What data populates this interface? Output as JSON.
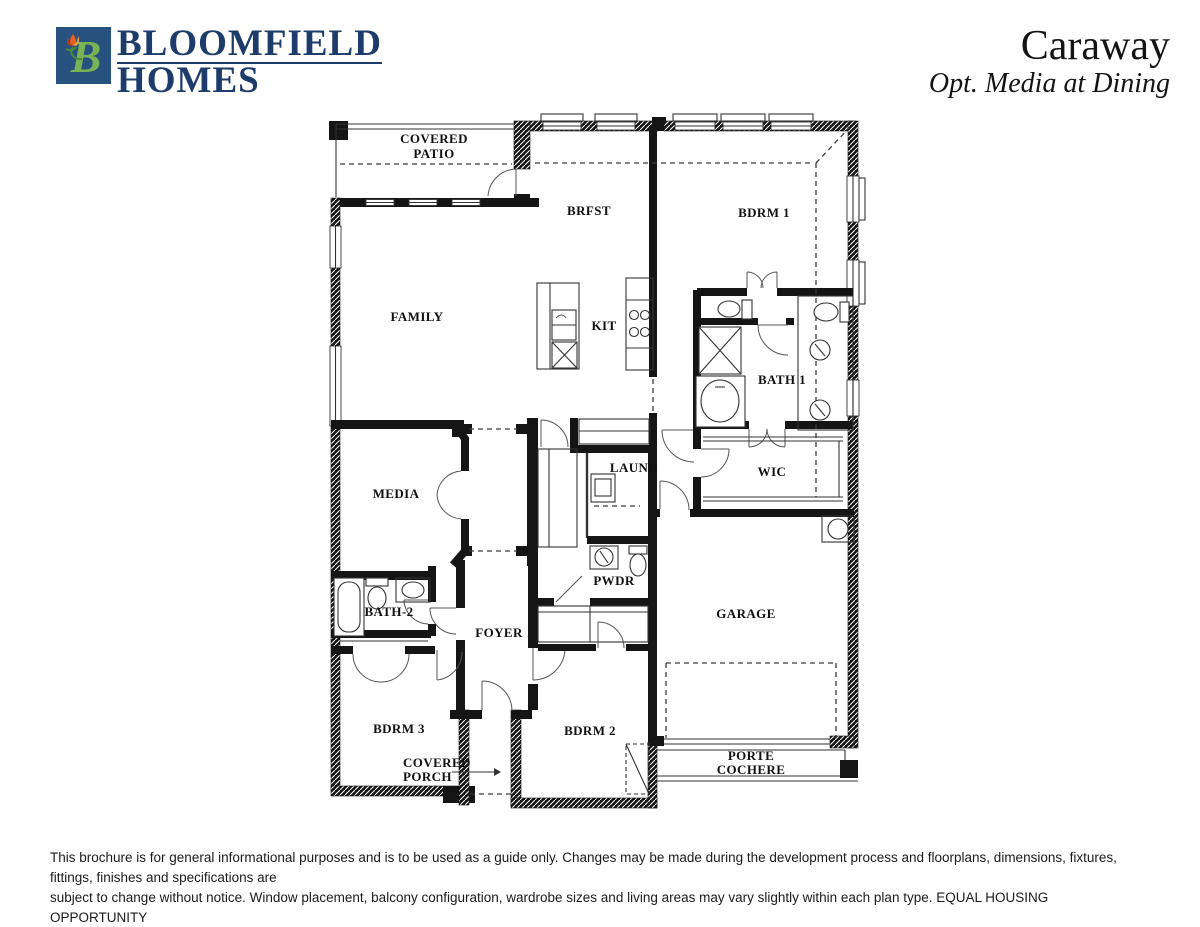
{
  "header": {
    "brand_line1": "BLOOMFIELD",
    "brand_line2": "HOMES",
    "plan_name": "Caraway",
    "plan_option": "Opt. Media at Dining"
  },
  "colors": {
    "brand_navy": "#1d3c6b",
    "logo_square_blue": "#27517e",
    "logo_b_green": "#79b356",
    "logo_tulip_orange": "#e8611f",
    "plan_ink": "#151515"
  },
  "plan": {
    "rooms": {
      "covered_patio": [
        "COVERED",
        "PATIO"
      ],
      "family": "FAMILY",
      "brfst": "BRFST",
      "kit": "KIT",
      "bdrm1": "BDRM 1",
      "bath1": "BATH 1",
      "media": "MEDIA",
      "laund": "LAUND",
      "wic": "WIC",
      "pwdr": "PWDR",
      "bath2": "BATH-2",
      "foyer": "FOYER",
      "bdrm3": "BDRM 3",
      "bdrm2": "BDRM 2",
      "garage": "GARAGE",
      "covered_porch": [
        "COVERED",
        "PORCH"
      ],
      "porte_cochere": [
        "PORTE",
        "COCHERE"
      ]
    }
  },
  "footer": {
    "disclaimer_line1": "This brochure is for general informational purposes and is to be used as a guide only. Changes may be made during the development process and floorplans, dimensions, fixtures, fittings, finishes and specifications are",
    "disclaimer_line2": "subject to change without notice. Window placement, balcony configuration, wardrobe sizes and living areas may vary slightly within each plan type.  EQUAL HOUSING OPPORTUNITY"
  }
}
